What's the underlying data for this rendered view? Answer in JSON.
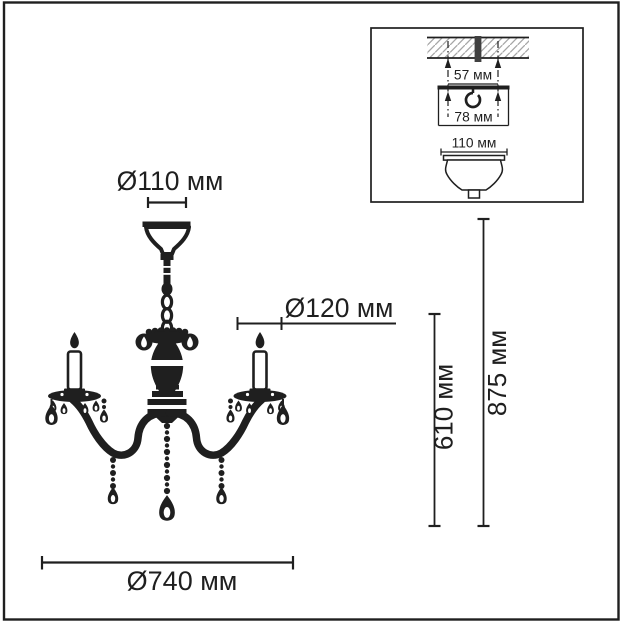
{
  "diagram": {
    "kind": "chandelier-dimension-drawing",
    "unit": "мм",
    "colors": {
      "ink": "#1f1f1f",
      "background": "#ffffff",
      "hatch": "#a6a6a6",
      "bolt": "#404040"
    }
  },
  "dims": {
    "canopy": {
      "label": "Ø110 мм",
      "value": 110
    },
    "cup": {
      "label": "Ø120 мм",
      "value": 120
    },
    "width": {
      "label": "Ø740 мм",
      "value": 740
    },
    "body_height": {
      "label": "610 мм",
      "value": 610
    },
    "total_height": {
      "label": "875 мм",
      "value": 875
    }
  },
  "inset": {
    "hole_spacing": {
      "label": "57 мм",
      "value": 57
    },
    "bracket_width": {
      "label": "78 мм",
      "value": 78
    },
    "canopy_width": {
      "label": "110 мм",
      "value": 110
    }
  }
}
